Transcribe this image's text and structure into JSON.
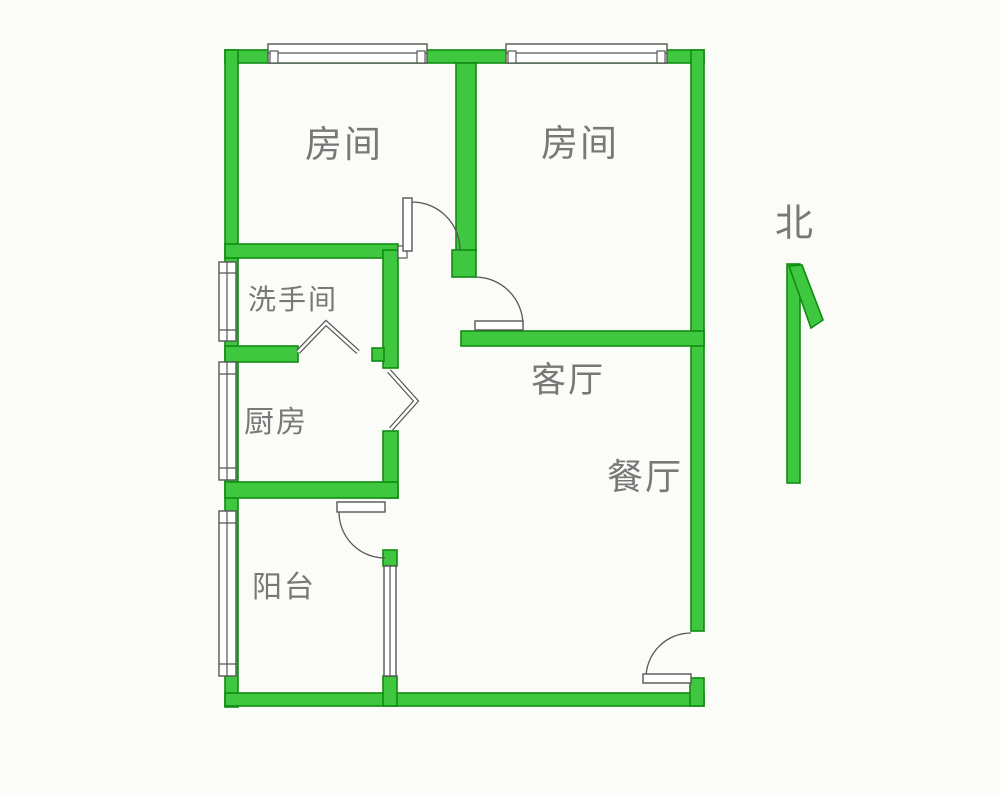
{
  "document": {
    "type": "floor-plan"
  },
  "compass": {
    "label": "北"
  },
  "rooms": [
    {
      "id": "bedroom-1",
      "label": "房间"
    },
    {
      "id": "bedroom-2",
      "label": "房间"
    },
    {
      "id": "bathroom",
      "label": "洗手间"
    },
    {
      "id": "kitchen",
      "label": "厨房"
    },
    {
      "id": "living-room",
      "label": "客厅"
    },
    {
      "id": "dining-room",
      "label": "餐厅"
    },
    {
      "id": "balcony",
      "label": "阳台"
    }
  ],
  "theme": {
    "wall_fill": "#3fc73f",
    "wall_edge": "#0f8c12",
    "line_color": "#565656",
    "leaf_fill": "#ffffff",
    "label_color": "#787878",
    "background": "#fbfbf8"
  }
}
